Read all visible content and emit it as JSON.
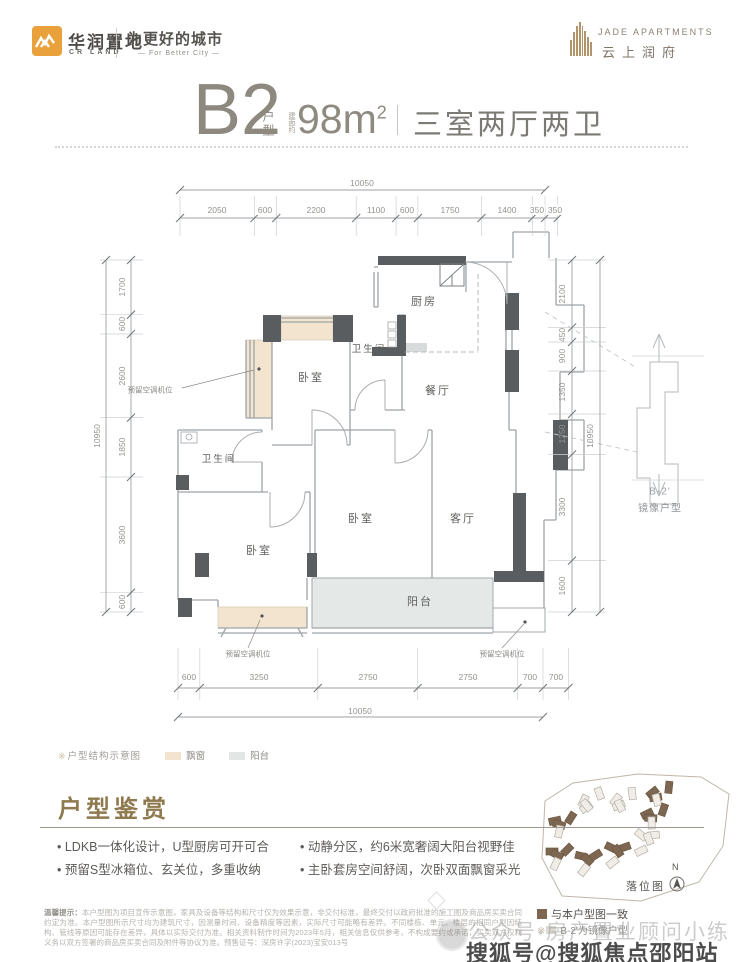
{
  "header": {
    "crland": {
      "name": "华润置地",
      "abbr": "CR LAND",
      "slogan": "为更好的城市",
      "slogan_en": "— For Better City —"
    },
    "project": {
      "name_en": "JADE APARTMENTS",
      "name_cn": "云上润府"
    }
  },
  "title": {
    "unit": "B2",
    "unit_label": "户型",
    "area_note": "建面约",
    "area_value": "98m",
    "area_sup": "2",
    "rooms": "三室两厅两卫"
  },
  "plan": {
    "dims": {
      "top_total": "10050",
      "top": [
        "2050",
        "600",
        "2200",
        "1100",
        "600",
        "1750",
        "1400",
        "350",
        "350"
      ],
      "bottom": [
        "600",
        "3250",
        "2750",
        "2750",
        "700",
        "700"
      ],
      "bottom_total": "10050",
      "left_total": "10950",
      "left": [
        "1700",
        "600",
        "2600",
        "1850",
        "3600",
        "600"
      ],
      "right": [
        "2100",
        "450",
        "900",
        "1350",
        "1250",
        "3300",
        "1600"
      ],
      "right_total": "10950"
    },
    "rooms": {
      "bedroom1": "卧室",
      "bath1": "卫生间",
      "kitchen": "厨房",
      "dining": "餐厅",
      "bath2": "卫生间",
      "bedroom2": "卧室",
      "bedroom3": "卧室",
      "living": "客厅",
      "balcony": "阳台"
    },
    "ac_note": "预留空调机位",
    "mirror": {
      "code": "B-2'",
      "label": "镜像户型"
    }
  },
  "legend": {
    "mark": "※",
    "note": "户型结构示意图",
    "bay": "飘窗",
    "balcony": "阳台"
  },
  "appreciation": {
    "heading": "户型鉴赏",
    "bullets_left": [
      "LDKB一体化设计，U型厨房可开可合",
      "预留S型冰箱位、玄关位，多重收纳"
    ],
    "bullets_right": [
      "动静分区，约6米宽奢阔大阳台视野佳",
      "主卧套房空间舒阔，次卧双面飘窗采光"
    ]
  },
  "sitemap": {
    "label": "落位图",
    "north": "N",
    "legend_match": "与本户型图一致",
    "legend_mirror_mark": "※",
    "legend_mirror": "B-2'为镜像户型"
  },
  "disclaimer": {
    "label": "温馨提示：",
    "text": "本户型图为项目宣传示意图，家具及设备等结构和尺寸仅为效果示意，非交付标准，最终交付以政府批准的施工图及商品房买卖合同约定为准。本户型图所示尺寸均为建筑尺寸，因测量时间、设备精度等因素，实际尺寸可能略有差异。不同楼栋、单元、楼层的相同户型因结构、管线等原因可能存在差异，具体以实际交付为准。相关资料制作时间为2023年5月，相关信息仅供参考，不构成要约或承诺，买卖双方权利义务以双方签署的商品房买卖合同及附件等协议为准。预售证号：深房许字(2023)宝安013号"
  },
  "watermarks": {
    "wechat": "公众号·房产置业顾问小练",
    "sohu": "搜狐号@搜狐焦点邵阳站"
  },
  "colors": {
    "accent_orange": "#e9a13b",
    "heading_brown": "#8f7a4f",
    "wall_dark": "#595d60",
    "bay_fill": "#f2e4cf",
    "balcony_fill": "#e4e9e7",
    "site_brown": "#7d6753"
  }
}
